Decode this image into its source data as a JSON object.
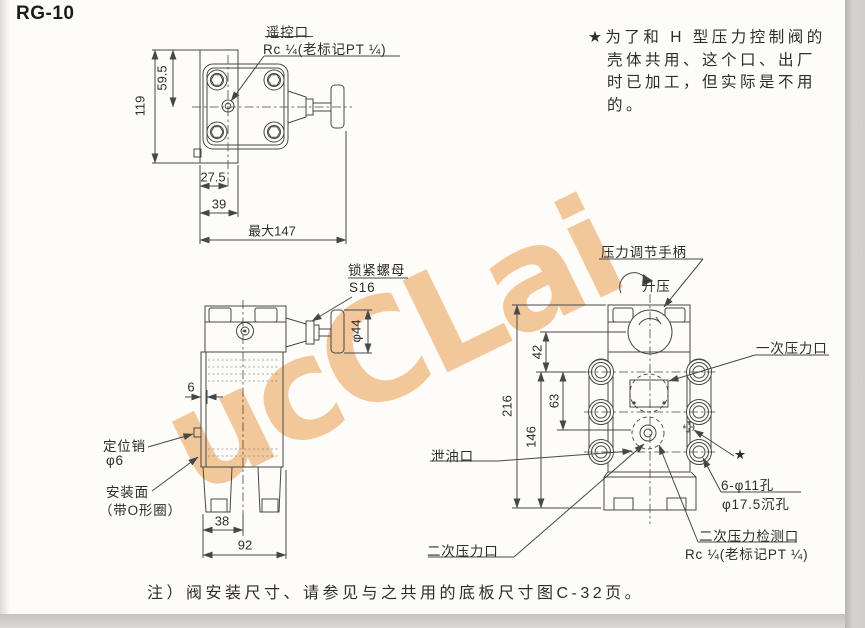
{
  "title": "RG-10",
  "colors": {
    "watermark": "#E8963E",
    "line": "#474747",
    "edge_strip": "#CDCCCA",
    "paper": "#FDFCF9"
  },
  "watermark": {
    "text": "ucCLai"
  },
  "star_note": {
    "lines": [
      "★为了和 H 型压力控制阀的",
      "壳体共用、这个口、出厂",
      "时已加工，但实际是不用",
      "的。"
    ]
  },
  "footer_note": "注）阀安装尺寸、请参见与之共用的底板尺寸图C-32页。",
  "top_view": {
    "remote_port_label": "遥控口",
    "remote_port_thread": "Rc ¼(老标记PT ¼)",
    "dim_119": "119",
    "dim_59_5": "59.5",
    "dim_27_5": "27.5",
    "dim_39": "39",
    "dim_max": "最大147"
  },
  "side_view": {
    "lock_nut_label": "锁紧螺母",
    "lock_nut_size": "S16",
    "knob_dia": "φ44",
    "dim_6": "6",
    "pin_label": "定位销",
    "pin_dia": "φ6",
    "mount_label": "安装面",
    "mount_sub": "（带O形圈）",
    "dim_38": "38",
    "dim_92": "92"
  },
  "front_view": {
    "handle_label": "压力调节手柄",
    "raise_label": "升压",
    "dim_216": "216",
    "dim_42": "42",
    "dim_63": "63",
    "dim_146": "146",
    "primary_port": "一次压力口",
    "star_mark": "★",
    "bolt_holes": "6-φ11孔",
    "counterbore": "φ17.5沉孔",
    "drain_port": "泄油口",
    "secondary_port": "二次压力口",
    "check_port": "二次压力检测口",
    "check_thread": "Rc ¼(老标记PT ¼)"
  }
}
